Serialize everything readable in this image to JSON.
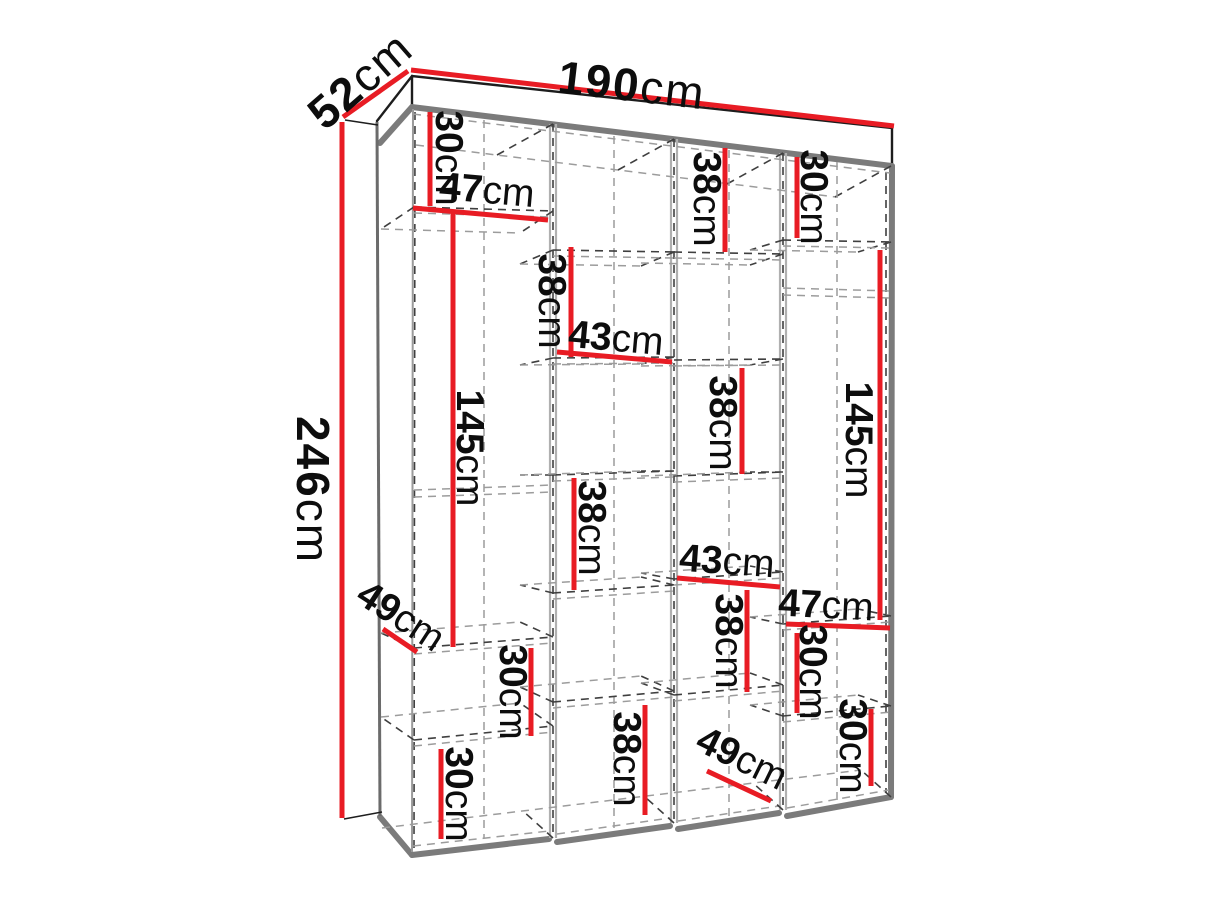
{
  "diagram": {
    "type": "furniture-dimension-diagram",
    "subject": "wardrobe interior with shelves and hanging sections, pseudo-3D view",
    "unit": "cm",
    "overall": {
      "width": "190cm",
      "depth": "52cm",
      "height": "246cm"
    },
    "dimensions": [
      {
        "id": "overall-width",
        "value": "190",
        "unit": "cm",
        "orientation": "horizontal",
        "area": "top edge"
      },
      {
        "id": "overall-depth",
        "value": "52",
        "unit": "cm",
        "orientation": "diagonal",
        "area": "top left depth edge"
      },
      {
        "id": "overall-height",
        "value": "246",
        "unit": "cm",
        "orientation": "vertical",
        "area": "left outer edge"
      },
      {
        "id": "col1-top-height",
        "value": "30",
        "unit": "cm",
        "orientation": "vertical",
        "area": "column 1 top compartment"
      },
      {
        "id": "col1-width",
        "value": "47",
        "unit": "cm",
        "orientation": "horizontal",
        "area": "column 1 shelf width"
      },
      {
        "id": "col1-hanging-height",
        "value": "145",
        "unit": "cm",
        "orientation": "vertical",
        "area": "column 1 hanging section"
      },
      {
        "id": "col1-shelf-depth",
        "value": "49",
        "unit": "cm",
        "orientation": "diagonal",
        "area": "column 1 lower shelf depth"
      },
      {
        "id": "col1-mid-height",
        "value": "30",
        "unit": "cm",
        "orientation": "vertical",
        "area": "column 1 lower compartment"
      },
      {
        "id": "col1-bottom-height",
        "value": "30",
        "unit": "cm",
        "orientation": "vertical",
        "area": "column 1 bottom compartment"
      },
      {
        "id": "col2-upper-height",
        "value": "38",
        "unit": "cm",
        "orientation": "vertical",
        "area": "column 2 upper compartment"
      },
      {
        "id": "col2-width",
        "value": "43",
        "unit": "cm",
        "orientation": "horizontal",
        "area": "column 2 shelf width"
      },
      {
        "id": "col2-mid-height",
        "value": "38",
        "unit": "cm",
        "orientation": "vertical",
        "area": "column 2 middle compartment"
      },
      {
        "id": "col2-bottom-height",
        "value": "38",
        "unit": "cm",
        "orientation": "vertical",
        "area": "column 2 bottom compartment"
      },
      {
        "id": "col3-top-height",
        "value": "38",
        "unit": "cm",
        "orientation": "vertical",
        "area": "column 3 top compartment"
      },
      {
        "id": "col3-upper-height",
        "value": "38",
        "unit": "cm",
        "orientation": "vertical",
        "area": "column 3 upper-middle compartment"
      },
      {
        "id": "col3-width",
        "value": "43",
        "unit": "cm",
        "orientation": "horizontal",
        "area": "column 3 shelf width"
      },
      {
        "id": "col3-lower-height",
        "value": "38",
        "unit": "cm",
        "orientation": "vertical",
        "area": "column 3 lower compartment"
      },
      {
        "id": "col3-floor-depth",
        "value": "49",
        "unit": "cm",
        "orientation": "diagonal",
        "area": "column 3 floor depth"
      },
      {
        "id": "col4-top-height",
        "value": "30",
        "unit": "cm",
        "orientation": "vertical",
        "area": "column 4 top compartment"
      },
      {
        "id": "col4-hanging-height",
        "value": "145",
        "unit": "cm",
        "orientation": "vertical",
        "area": "column 4 hanging section"
      },
      {
        "id": "col4-width",
        "value": "47",
        "unit": "cm",
        "orientation": "horizontal",
        "area": "column 4 shelf width"
      },
      {
        "id": "col4-mid-height",
        "value": "30",
        "unit": "cm",
        "orientation": "vertical",
        "area": "column 4 lower compartment"
      },
      {
        "id": "col4-bottom-height",
        "value": "30",
        "unit": "cm",
        "orientation": "vertical",
        "area": "column 4 bottom compartment"
      }
    ]
  },
  "colors": {
    "dimension": "#e81c24",
    "label": "#0d0d0d",
    "outline": "#1d1d1d",
    "edge": "#7b7b7b",
    "hidden": "#3f3f3f",
    "hidden_light": "#9c9c9c",
    "background": "#ffffff"
  }
}
